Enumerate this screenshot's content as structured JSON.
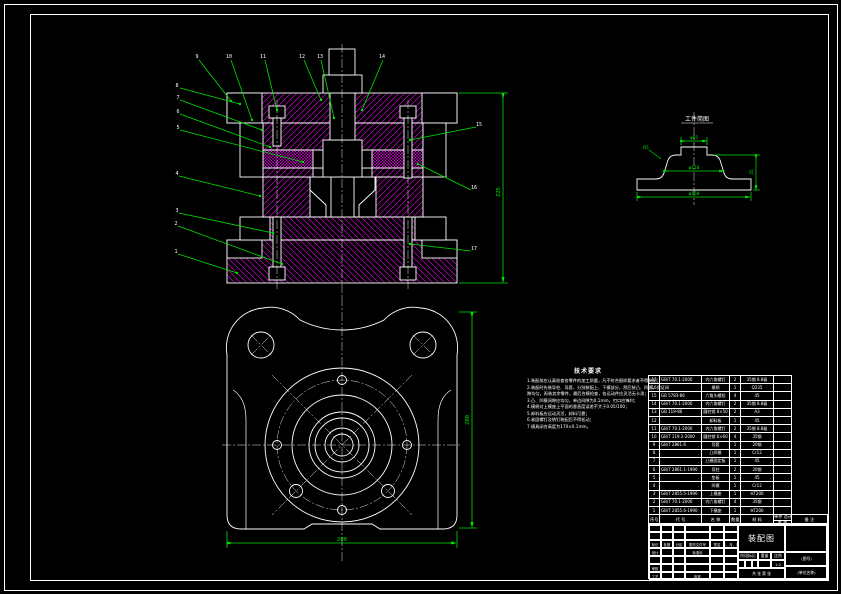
{
  "drawing": {
    "colors": {
      "line_green": "#00e400",
      "hatch_magenta": "#ff00ff",
      "line_white": "#ffffff",
      "background": "#000000"
    }
  },
  "section": {
    "balloons": [
      "9",
      "10",
      "11",
      "12",
      "13",
      "14",
      "8",
      "7",
      "6",
      "5",
      "4",
      "3",
      "2",
      "1",
      "15",
      "16",
      "17"
    ],
    "dim_height": "225"
  },
  "plan": {
    "dim_width": "200",
    "dim_height": "200"
  },
  "part_detail": {
    "title": "工件简图",
    "dim_top": "φ65",
    "dim_mid": "φ110",
    "dim_bottom": "φ150",
    "dim_height": "35",
    "dim_fillet": "R5"
  },
  "tech_requirements": {
    "title": "技术要求",
    "lines": [
      "1.装配前应认真检查各零件的加工质量，凡不符合图样要求者不得装配；",
      "2.装配时先装导柱、导套，分别装配上、下模部分，然后装凸、凹模，保证间",
      "  隙均匀，再装其余零件，最后合模检查，各运动件应灵活无卡滞；",
      "3.凸、凹模间隙应均匀，单边间隙为0.1mm，刃口应锋利；",
      "4.模柄对上模座上平面的垂直度误差不大于0.05/100；",
      "5.卸料板应运动灵活，卸料可靠；",
      "6.紧固螺钉及销钉装配后不得松动；",
      "7.模具闭合高度为170±0.1mm。"
    ]
  },
  "bom": {
    "headers": {
      "no": "序号",
      "code": "代  号",
      "name": "名  称",
      "qty": "数量",
      "mat": "材  料",
      "w_top": "单件 总计",
      "w_bot": "重  量",
      "note": "备 注"
    },
    "rows": [
      [
        "17",
        "GB/T 70.1-2000",
        "内六角螺钉",
        "2",
        "35钢 8.8级",
        ""
      ],
      [
        "16",
        "",
        "模柄",
        "1",
        "Q235",
        ""
      ],
      [
        "15",
        "GB 5783-86",
        "六角头螺栓",
        "4",
        "45",
        ""
      ],
      [
        "14",
        "GB/T 70.1-2000",
        "内六角螺钉",
        "2",
        "35钢 8.8级",
        ""
      ],
      [
        "13",
        "GB 119-86",
        "圆柱销 8×50",
        "2",
        "A3",
        ""
      ],
      [
        "12",
        "",
        "卸料板",
        "1",
        "45",
        ""
      ],
      [
        "11",
        "GB/T 70.1-2000",
        "内六角螺钉",
        "2",
        "35钢 8.8级",
        ""
      ],
      [
        "10",
        "GB/T 119.2-2000",
        "圆柱销 6×60",
        "4",
        "35钢",
        ""
      ],
      [
        "9",
        "GB/T 2861.6",
        "导套",
        "1",
        "20钢",
        ""
      ],
      [
        "8",
        "",
        "凸凹模",
        "1",
        "Cr12",
        ""
      ],
      [
        "7",
        "",
        "凸模固定板",
        "1",
        "45",
        ""
      ],
      [
        "6",
        "GB/T 2861.1-1990",
        "导柱",
        "2",
        "20钢",
        ""
      ],
      [
        "5",
        "",
        "垫板",
        "1",
        "45",
        ""
      ],
      [
        "4",
        "",
        "凹模",
        "1",
        "Cr12",
        ""
      ],
      [
        "3",
        "GB/T 2855.5-1990",
        "上模座",
        "1",
        "HT200",
        ""
      ],
      [
        "2",
        "GB/T 70.1-2000",
        "内六角螺钉",
        "4",
        "35钢",
        ""
      ],
      [
        "1",
        "GB/T 2855.6-1990",
        "下模座",
        "1",
        "HT200",
        ""
      ]
    ]
  },
  "title_block": {
    "change_row": [
      "标记",
      "处数",
      "分区",
      "更改文件号",
      "签名",
      "年、月、日"
    ],
    "design": "设计",
    "standard": "标准化",
    "audit": "审核",
    "process": "工艺",
    "approve": "批准",
    "stage_label": "阶段标记",
    "weight_label": "重量",
    "scale_label": "比例",
    "scale_value": "1:2",
    "sheet_label": "共 张 第 张",
    "title": "装配图",
    "drawing_no": "(图号)",
    "company": "(单位名称)"
  }
}
